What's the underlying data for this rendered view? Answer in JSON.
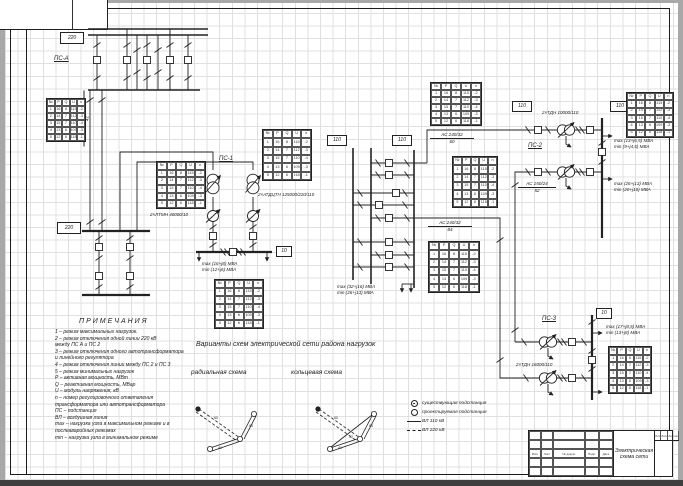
{
  "drawing": {
    "substations": {
      "ps_a": "ПС-А",
      "ps_1": "ПС-1",
      "ps_2": "ПС-2",
      "ps_3": "ПС-3"
    },
    "voltages": {
      "kv220": "220",
      "kv110": "110",
      "kv10": "10"
    },
    "lines": {
      "feed": {
        "type": "2×АС 240/32",
        "length": "41"
      },
      "ring1": {
        "type": "АС 240/32",
        "length": "60"
      },
      "ring2": {
        "type": "АС 240/32",
        "length": "84"
      },
      "ring3": {
        "type": "АС 150/24",
        "length": "52"
      }
    },
    "equipment": {
      "autotransformer": "2×АТДЦТН 125000/220/110",
      "regulator": "2×ЛТМН 40000/10",
      "transformer_ps2": "2×ТДН 10000/110",
      "transformer_ps3": "2×ТДН 16000/110"
    },
    "loads": {
      "ps1_max": "max (16+j8) МВА",
      "ps1_min": "min (12+j6) МВА",
      "mid_max": "max (32+j16) МВА",
      "mid_min": "min (26+j13) МВА",
      "ps2a_max": "max (13+j6,5) МВА",
      "ps2a_min": "min (9+j4,5) МВА",
      "ps2b_max": "max (26+j13) МВА",
      "ps2b_min": "min (20+j10) МВА",
      "ps3_max": "max (17+j8,5) МВА",
      "ps3_min": "min (13+j8) МВА"
    }
  },
  "captions": {
    "variants": "Варианты схем электрической сети района нагрузок",
    "radial": "радиальная схема",
    "ring": "кольцевая схема"
  },
  "notes": {
    "title": "ПРИМЕЧАНИЯ",
    "lines": [
      "1  –  режим максимальных нагрузок.",
      "2  –  режим отключения одной линии 220 кВ",
      "между ПС А и ПС 2",
      "3  –  режим отключения одного автотрансформатора",
      "и линейного регулятора",
      "4  –  режим отключения линии между ПС 2 и ПС 3",
      "5  –  режим минимальных нагрузок",
      "Р  –  активная мощность, МВт",
      "Q  –  реактивная мощность, МВар",
      "U  –  модуль напряжения, кВ",
      "n  –  номер регулировочного ответвления",
      "трансформатора или автотрансформатора",
      "ПС –  подстанция",
      "ВЛ –  воздушная линия",
      "max –  нагрузка узла в максимальном режиме и в",
      "послеаварийных режимах",
      "min –  нагрузка узла в минимальном режиме"
    ]
  },
  "legend": {
    "existing": "существующая подстанция",
    "planned": "проектируемая подстанция",
    "vl110": "ВЛ 110 кВ",
    "vl220": "ВЛ 220 кВ"
  },
  "tables": {
    "header": [
      "№",
      "P",
      "Q",
      "U",
      "n"
    ],
    "rows": [
      [
        "1",
        "16",
        "8",
        "115",
        "-2"
      ],
      [
        "2",
        "14",
        "7",
        "112",
        "-3"
      ],
      [
        "3",
        "15",
        "7",
        "110",
        "-4"
      ],
      [
        "4",
        "13",
        "6",
        "109",
        "-3"
      ],
      [
        "5",
        "12",
        "6",
        "118",
        "-1"
      ]
    ]
  },
  "sketches": {
    "radial": [
      "60",
      "41",
      "84"
    ],
    "ring": [
      "60",
      "41",
      "84",
      "52"
    ]
  },
  "title_block": {
    "title": "Электрическая схема сети",
    "cols": [
      "Изм.",
      "Лист",
      "№ докум.",
      "Подп.",
      "Дата"
    ],
    "right": [
      "Лит.",
      "Лист",
      "Листов"
    ]
  }
}
